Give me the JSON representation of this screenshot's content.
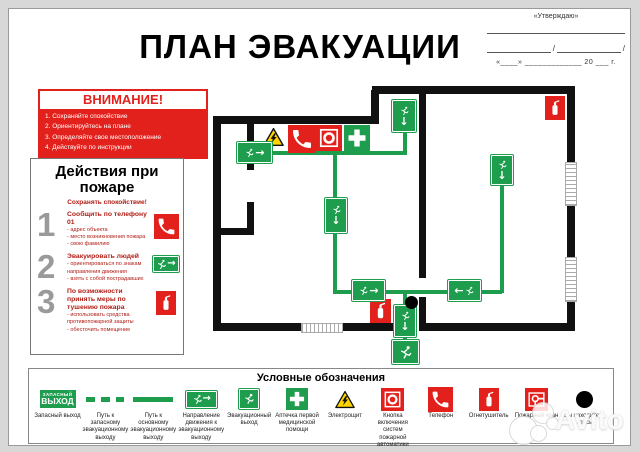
{
  "header": {
    "title": "ПЛАН ЭВАКУАЦИИ"
  },
  "approval": {
    "label": "«Утверждаю»",
    "slash": "/",
    "date_line": "«____» _____________ 20 ___ г."
  },
  "attention": {
    "title": "ВНИМАНИЕ!",
    "items": [
      "1. Сохраняйте спокойствие",
      "2. Ориентируйтесь на плане",
      "3. Определяйте свое местоположение",
      "4. Действуйте по инструкции"
    ]
  },
  "actions": {
    "title": "Действия при пожаре",
    "subtitle": "Сохранять спокойствие!",
    "steps": [
      {
        "number": "1",
        "title": "Сообщить по телефону 01",
        "details": [
          "- адрес объекта",
          "- место возникновения пожара",
          "- свою фамилию"
        ],
        "icon": "phone-icon"
      },
      {
        "number": "2",
        "title": "Эвакуировать людей",
        "details": [
          "- ориентироваться по знакам направления движения",
          "- взять с собой пострадавших"
        ],
        "icon": "exit-sign-icon"
      },
      {
        "number": "3",
        "title": "По возможности принять меры по тушению пожара",
        "details": [
          "- использовать средства противопожарной защиты",
          "- обесточить помещение"
        ],
        "icon": "fire-extinguisher-icon"
      }
    ]
  },
  "legend": {
    "title": "Условные обозначения",
    "exit_sign": {
      "line1": "ЗАПАСНЫЙ",
      "line2": "ВЫХОД"
    },
    "items": [
      {
        "icon": "emergency-exit-sign-icon",
        "label": "Запасный выход"
      },
      {
        "icon": "dashed-route-icon",
        "label": "Путь к запасному эвакуационному выходу"
      },
      {
        "icon": "solid-route-icon",
        "label": "Путь к основному эвакуационному выходу"
      },
      {
        "icon": "direction-sign-icon",
        "label": "Направление движения к эвакуационному выходу"
      },
      {
        "icon": "evacuation-exit-icon",
        "label": "Эвакуационный выход"
      },
      {
        "icon": "first-aid-icon",
        "label": "Аптечка первой медицинской помощи"
      },
      {
        "icon": "electrical-panel-icon",
        "label": "Электрощит"
      },
      {
        "icon": "fire-alarm-button-icon",
        "label": "Кнопка включения систем пожарной автоматики"
      },
      {
        "icon": "phone-icon",
        "label": "Телефон"
      },
      {
        "icon": "fire-extinguisher-icon",
        "label": "Огнетушитель"
      },
      {
        "icon": "fire-hose-icon",
        "label": "Пожарный кран"
      },
      {
        "icon": "you-are-here-icon",
        "label": "Вы находитесь здесь"
      }
    ]
  },
  "icons": {
    "down_arrow": "↓",
    "right_arrow": "→",
    "left_arrow": "←"
  },
  "watermark": {
    "text": "Avito"
  },
  "colors": {
    "green": "#1F9D4E",
    "red": "#E2211C",
    "yellow": "#FFD500"
  }
}
